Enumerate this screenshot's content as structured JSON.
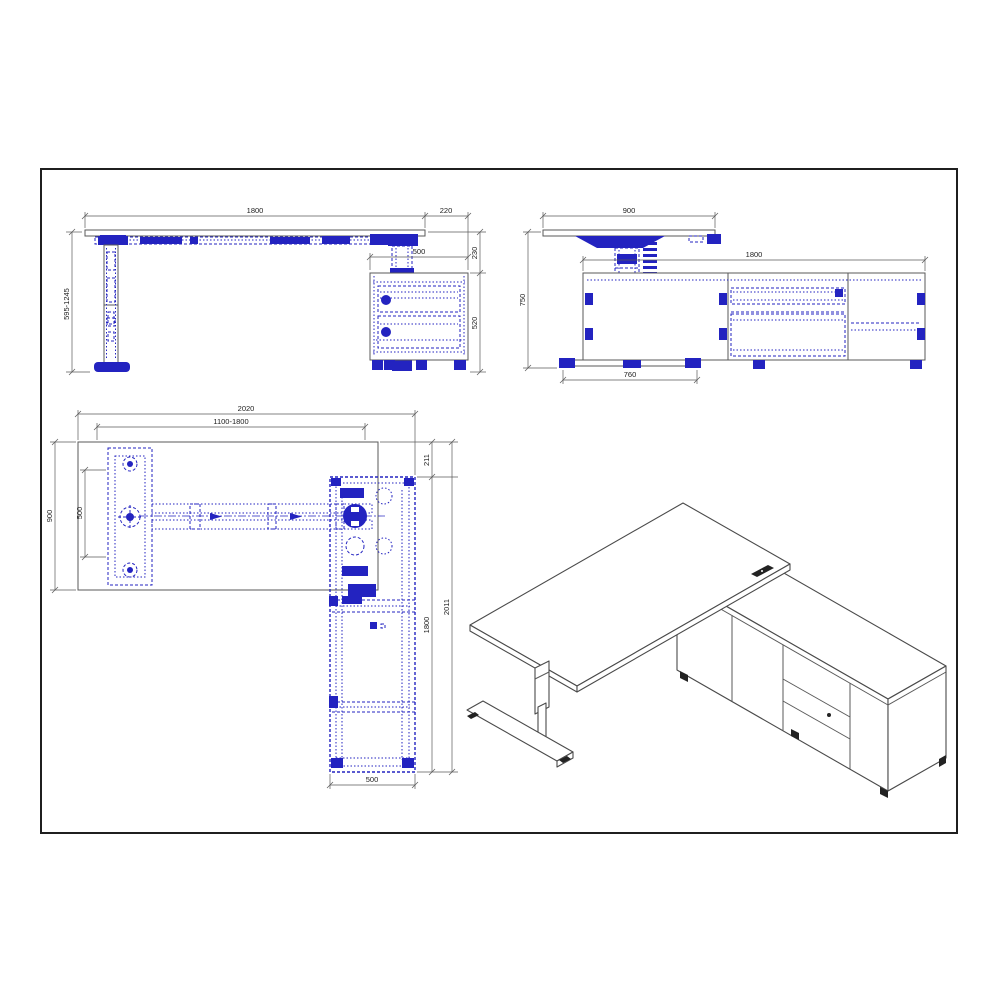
{
  "sheet": {
    "background": "#ffffff",
    "frame_color": "#1f1f1f"
  },
  "colors": {
    "outline": "#5a5a5a",
    "hidden_line_blue": "#2323c0",
    "text": "#1c1c1c"
  },
  "views": {
    "front": {
      "name": "front-elevation",
      "desk_width": "1800",
      "side_overhang": "220",
      "cabinet_width": "500",
      "height_range": "595-1245",
      "top_to_cabinet": "230",
      "cabinet_height": "520"
    },
    "side": {
      "name": "side-elevation",
      "desk_depth": "900",
      "cabinet_length": "1800",
      "total_height": "750",
      "foot_length": "760"
    },
    "plan": {
      "name": "plan-view",
      "overall_width": "2020",
      "adjustable_range": "1100-1800",
      "desk_depth": "900",
      "foot_span": "500",
      "rear_offset": "211",
      "cabinet_length": "1800",
      "overall_depth": "2011",
      "cabinet_depth": "500"
    },
    "isometric": {
      "name": "isometric-view"
    }
  }
}
